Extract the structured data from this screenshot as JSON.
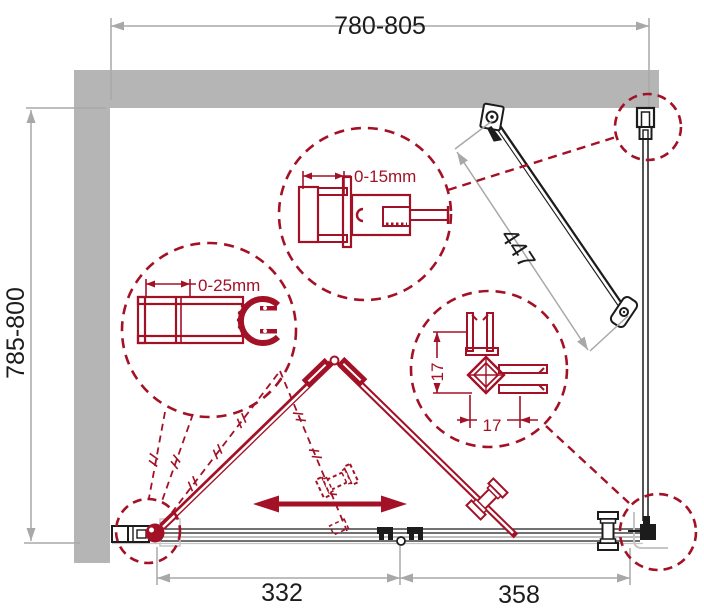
{
  "colors": {
    "accent_red": "#a31126",
    "wall_gray": "#b5b5b5",
    "dim_gray": "#a8a8a8",
    "line_black": "#1c1c1c",
    "track_gray": "#999999",
    "tray_gray": "#c6c6c6"
  },
  "dimensions": {
    "width_range": "780-805",
    "depth_range": "785-800",
    "support_bar_length": "447",
    "door_section_width": "332",
    "fixed_section_width": "358"
  },
  "details": {
    "top_profile_adjustment": "0-15mm",
    "wall_profile_adjustment": "0-25mm",
    "corner_post_depth": "17",
    "corner_post_width": "17"
  }
}
